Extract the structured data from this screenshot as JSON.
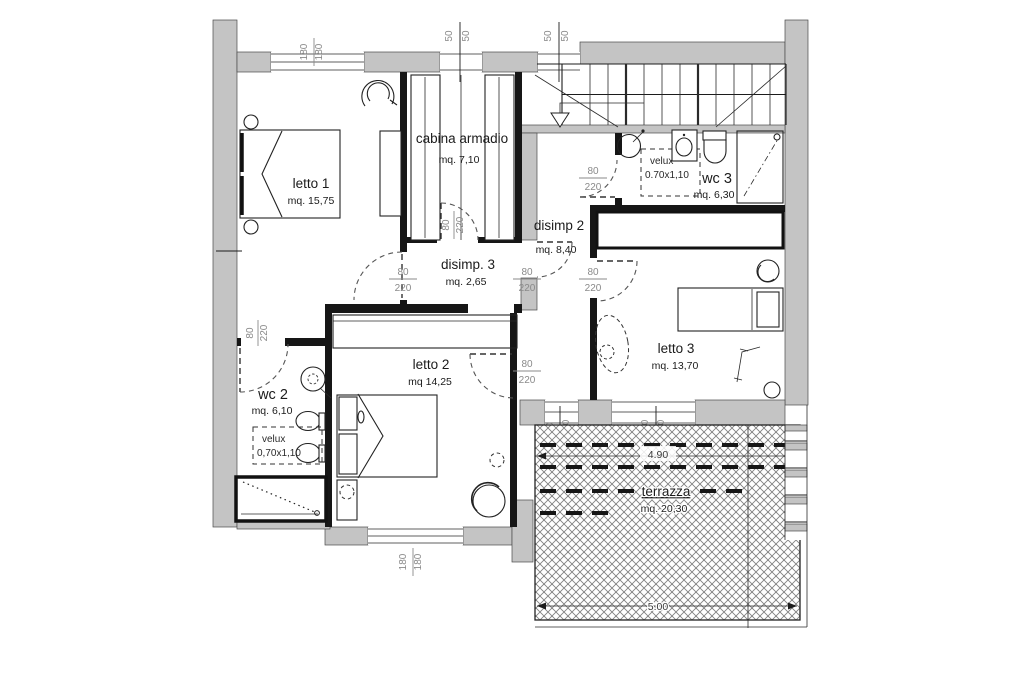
{
  "plan": {
    "type": "floor-plan",
    "language": "italian",
    "colors": {
      "wall_gray": "#c4c4c4",
      "wall_dark": "#161616",
      "dim_text": "#8a8a8a",
      "ink": "#1c1c1c"
    }
  },
  "rooms": {
    "letto1": {
      "name": "letto 1",
      "area": "mq. 15,75"
    },
    "cabina": {
      "name": "cabina armadio",
      "area": "mq. 7,10"
    },
    "disimp3": {
      "name": "disimp. 3",
      "area": "mq. 2,65"
    },
    "disimp2": {
      "name": "disimp 2",
      "area": "mq. 8,40"
    },
    "wc2": {
      "name": "wc 2",
      "area": "mq. 6,10"
    },
    "wc3": {
      "name": "wc 3",
      "area": "mq. 6,30"
    },
    "letto2": {
      "name": "letto 2",
      "area": "mq 14,25"
    },
    "letto3": {
      "name": "letto 3",
      "area": "mq. 13,70"
    },
    "terrazza": {
      "name": "terrazza",
      "area": "mq. 20,30"
    }
  },
  "velux": {
    "wc2": {
      "label": "velux",
      "size": "0,70x1,10"
    },
    "wc3": {
      "label": "velux",
      "size": "0.70x1,10"
    }
  },
  "dims": {
    "d50": "50",
    "d80": "80",
    "d90": "90",
    "d180": "180",
    "d220": "220",
    "d240": "240"
  },
  "terrace_dims": {
    "top": "4.90",
    "bottom": "5.00"
  }
}
